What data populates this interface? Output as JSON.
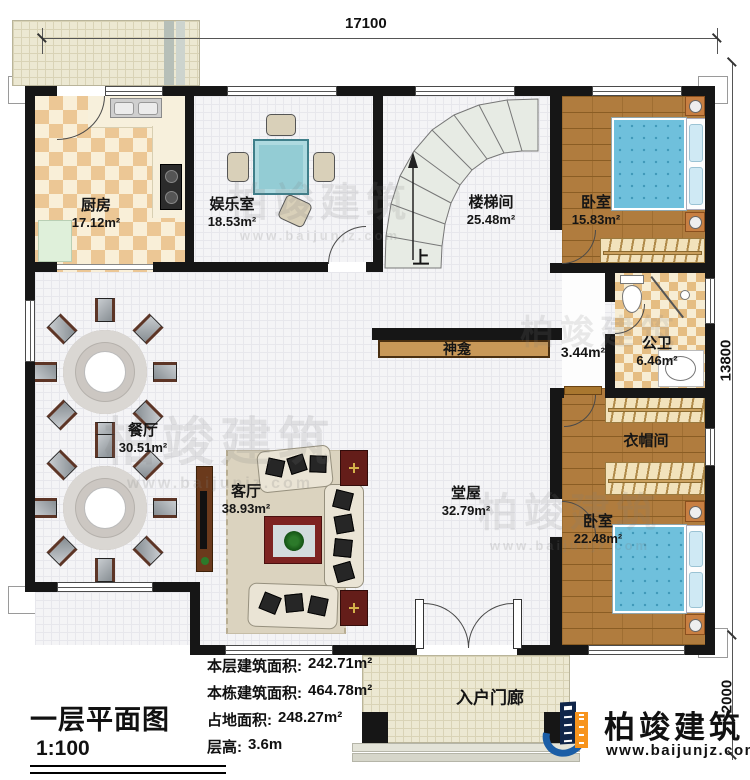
{
  "title_block": {
    "title": "一层平面图",
    "scale": "1:100"
  },
  "stats": {
    "floor_area_label": "本层建筑面积:",
    "floor_area": "242.71m²",
    "building_area_label": "本栋建筑面积:",
    "building_area": "464.78m²",
    "footprint_label": "占地面积:",
    "footprint": "248.27m²",
    "height_label": "层高:",
    "height": "3.6m"
  },
  "dimensions": {
    "top": "17100",
    "right": "13800",
    "bottom_right": "2000"
  },
  "rooms": {
    "kitchen": {
      "name": "厨房",
      "area": "17.12m²"
    },
    "recreation": {
      "name": "娱乐室",
      "area": "18.53m²"
    },
    "stairwell": {
      "name": "楼梯间",
      "area": "25.48m²",
      "direction": "上"
    },
    "bedroom1": {
      "name": "卧室",
      "area": "15.83m²"
    },
    "corridor": {
      "area": "3.44m²"
    },
    "bathroom": {
      "name": "公卫",
      "area": "6.46m²"
    },
    "cloakroom": {
      "name": "衣帽间"
    },
    "bedroom2": {
      "name": "卧室",
      "area": "22.48m²"
    },
    "hall": {
      "name": "堂屋",
      "area": "32.79m²"
    },
    "living": {
      "name": "客厅",
      "area": "38.93m²"
    },
    "dining": {
      "name": "餐厅",
      "area": "30.51m²"
    },
    "shrine": {
      "name": "神龛"
    },
    "porch": {
      "name": "入户门廊"
    }
  },
  "brand": {
    "name": "柏竣建筑",
    "website": "www.baijunjz.com"
  }
}
